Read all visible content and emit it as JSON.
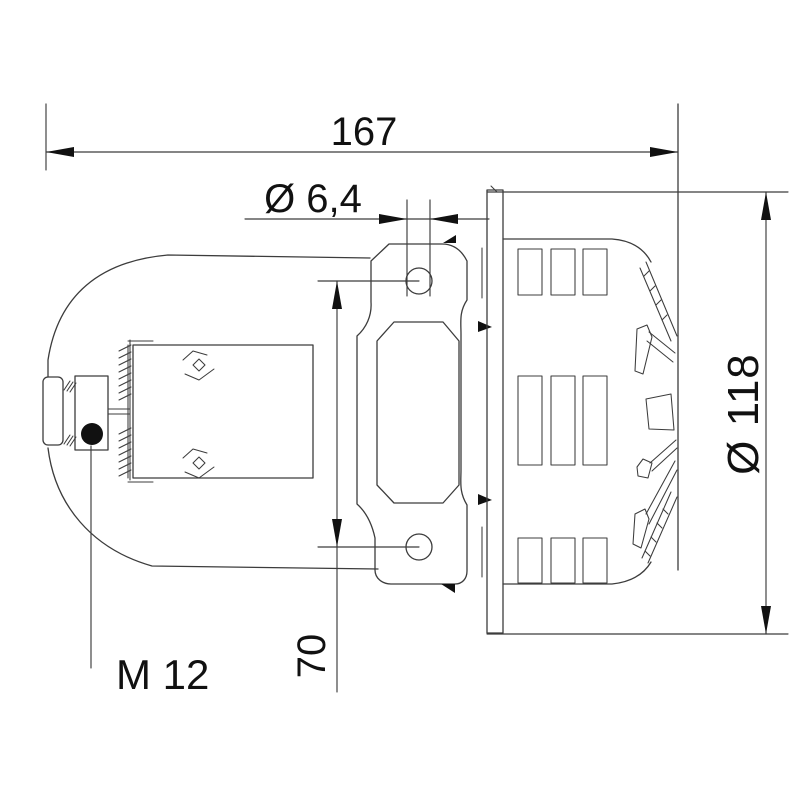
{
  "drawing": {
    "description": "Technical dimension drawing, side view of a motor siren: domed motor housing with M12 cable gland on the left, central mounting bracket with two holes, flange and louvered rotor housing on the right",
    "background": "#ffffff",
    "line_color": "#3c3c3c",
    "text_color": "#111111",
    "labels": {
      "overall_length": "167",
      "mounting_hole_diameter": "Ø 6,4",
      "mounting_hole_spacing": "70",
      "flange_diameter": "Ø 118",
      "cable_gland_thread": "M 12"
    }
  }
}
